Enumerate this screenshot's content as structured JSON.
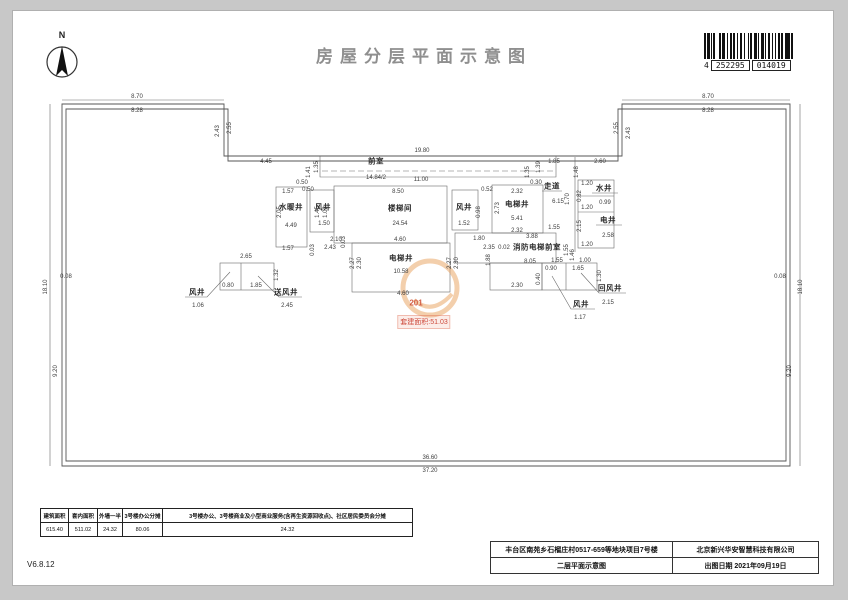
{
  "header": {
    "title": "房屋分层平面示意图",
    "north_label": "N",
    "barcode": {
      "g1": "4",
      "g2": "252295",
      "g3": "014019"
    }
  },
  "watermark": {
    "unit": "201",
    "text": "套建面积:51.03"
  },
  "plan": {
    "rooms": [
      {
        "t": "前室",
        "x": 376,
        "y": 161
      },
      {
        "t": "水暖井",
        "x": 291,
        "y": 207
      },
      {
        "t": "风井",
        "x": 323,
        "y": 207
      },
      {
        "t": "楼梯间",
        "x": 400,
        "y": 208
      },
      {
        "t": "电梯井",
        "x": 401,
        "y": 258
      },
      {
        "t": "电梯井",
        "x": 517,
        "y": 204
      },
      {
        "t": "风井",
        "x": 464,
        "y": 207
      },
      {
        "t": "走道",
        "x": 552,
        "y": 186
      },
      {
        "t": "水井",
        "x": 604,
        "y": 188
      },
      {
        "t": "电井",
        "x": 608,
        "y": 220
      },
      {
        "t": "消防电梯前室",
        "x": 537,
        "y": 247
      },
      {
        "t": "风井",
        "x": 197,
        "y": 292
      },
      {
        "t": "送风井",
        "x": 286,
        "y": 292
      },
      {
        "t": "风井",
        "x": 581,
        "y": 304
      },
      {
        "t": "回风井",
        "x": 610,
        "y": 288
      }
    ],
    "dims": [
      {
        "t": "8.70",
        "x": 137,
        "y": 97
      },
      {
        "t": "8.28",
        "x": 137,
        "y": 111
      },
      {
        "t": "8.70",
        "x": 708,
        "y": 97
      },
      {
        "t": "8.28",
        "x": 708,
        "y": 111
      },
      {
        "t": "2.43",
        "x": 218,
        "y": 131,
        "r": 1
      },
      {
        "t": "2.55",
        "x": 230,
        "y": 128,
        "r": 1
      },
      {
        "t": "2.55",
        "x": 617,
        "y": 128,
        "r": 1
      },
      {
        "t": "2.43",
        "x": 629,
        "y": 133,
        "r": 1
      },
      {
        "t": "4.45",
        "x": 266,
        "y": 162
      },
      {
        "t": "2.60",
        "x": 600,
        "y": 162
      },
      {
        "t": "19.80",
        "x": 422,
        "y": 151
      },
      {
        "t": "14.84/2",
        "x": 376,
        "y": 178
      },
      {
        "t": "11.00",
        "x": 421,
        "y": 180
      },
      {
        "t": "18.10",
        "x": 46,
        "y": 287,
        "r": 1
      },
      {
        "t": "0.08",
        "x": 66,
        "y": 277
      },
      {
        "t": "9.20",
        "x": 56,
        "y": 371,
        "r": 1
      },
      {
        "t": "18.10",
        "x": 801,
        "y": 287,
        "r": 1
      },
      {
        "t": "0.08",
        "x": 780,
        "y": 277
      },
      {
        "t": "9.20",
        "x": 790,
        "y": 371,
        "r": 1
      },
      {
        "t": "36.60",
        "x": 430,
        "y": 458
      },
      {
        "t": "37.20",
        "x": 430,
        "y": 471
      },
      {
        "t": "1.35",
        "x": 317,
        "y": 167,
        "r": 1
      },
      {
        "t": "1.41",
        "x": 309,
        "y": 172,
        "r": 1
      },
      {
        "t": "0.50",
        "x": 302,
        "y": 183
      },
      {
        "t": "1.39",
        "x": 539,
        "y": 167,
        "r": 1
      },
      {
        "t": "1.35",
        "x": 528,
        "y": 172,
        "r": 1
      },
      {
        "t": "0.30",
        "x": 536,
        "y": 183
      },
      {
        "t": "1.85",
        "x": 554,
        "y": 162
      },
      {
        "t": "1.48",
        "x": 577,
        "y": 172,
        "r": 1
      },
      {
        "t": "1.57",
        "x": 288,
        "y": 192
      },
      {
        "t": "2.05",
        "x": 280,
        "y": 212,
        "r": 1
      },
      {
        "t": "4.49",
        "x": 291,
        "y": 226
      },
      {
        "t": "1.57",
        "x": 288,
        "y": 249
      },
      {
        "t": "0.50",
        "x": 308,
        "y": 190
      },
      {
        "t": "0.03",
        "x": 313,
        "y": 250,
        "r": 1
      },
      {
        "t": "1.45",
        "x": 318,
        "y": 212,
        "r": 1
      },
      {
        "t": "1.02",
        "x": 326,
        "y": 212,
        "r": 1
      },
      {
        "t": "1.50",
        "x": 324,
        "y": 224
      },
      {
        "t": "8.50",
        "x": 398,
        "y": 192
      },
      {
        "t": "24.54",
        "x": 400,
        "y": 224
      },
      {
        "t": "4.60",
        "x": 400,
        "y": 240
      },
      {
        "t": "2.10",
        "x": 336,
        "y": 240
      },
      {
        "t": "2.43",
        "x": 330,
        "y": 248
      },
      {
        "t": "0.03",
        "x": 344,
        "y": 242,
        "r": 1
      },
      {
        "t": "2.27",
        "x": 353,
        "y": 263,
        "r": 1
      },
      {
        "t": "2.30",
        "x": 360,
        "y": 263,
        "r": 1
      },
      {
        "t": "10.58",
        "x": 401,
        "y": 272
      },
      {
        "t": "4.60",
        "x": 403,
        "y": 294
      },
      {
        "t": "2.27",
        "x": 450,
        "y": 263,
        "r": 1
      },
      {
        "t": "2.30",
        "x": 457,
        "y": 263,
        "r": 1
      },
      {
        "t": "1.52",
        "x": 464,
        "y": 224
      },
      {
        "t": "0.98",
        "x": 479,
        "y": 212,
        "r": 1
      },
      {
        "t": "2.73",
        "x": 498,
        "y": 208,
        "r": 1
      },
      {
        "t": "0.52",
        "x": 487,
        "y": 190
      },
      {
        "t": "2.32",
        "x": 517,
        "y": 192
      },
      {
        "t": "5.41",
        "x": 517,
        "y": 219
      },
      {
        "t": "2.32",
        "x": 517,
        "y": 231
      },
      {
        "t": "6.15",
        "x": 558,
        "y": 202
      },
      {
        "t": "1.70",
        "x": 568,
        "y": 199,
        "r": 1
      },
      {
        "t": "1.20",
        "x": 587,
        "y": 184
      },
      {
        "t": "0.82",
        "x": 580,
        "y": 196,
        "r": 1
      },
      {
        "t": "1.20",
        "x": 587,
        "y": 208
      },
      {
        "t": "0.99",
        "x": 605,
        "y": 203
      },
      {
        "t": "2.15",
        "x": 580,
        "y": 226,
        "r": 1
      },
      {
        "t": "2.58",
        "x": 608,
        "y": 236
      },
      {
        "t": "1.20",
        "x": 587,
        "y": 245
      },
      {
        "t": "1.80",
        "x": 479,
        "y": 239
      },
      {
        "t": "2.35",
        "x": 489,
        "y": 248
      },
      {
        "t": "0.02",
        "x": 504,
        "y": 248
      },
      {
        "t": "1.88",
        "x": 489,
        "y": 260,
        "r": 1
      },
      {
        "t": "1.55",
        "x": 554,
        "y": 228
      },
      {
        "t": "3.88",
        "x": 532,
        "y": 237
      },
      {
        "t": "8.05",
        "x": 530,
        "y": 262
      },
      {
        "t": "2.30",
        "x": 517,
        "y": 286
      },
      {
        "t": "0.40",
        "x": 539,
        "y": 279,
        "r": 1
      },
      {
        "t": "1.55",
        "x": 567,
        "y": 250,
        "r": 1
      },
      {
        "t": "1.46",
        "x": 573,
        "y": 255,
        "r": 1
      },
      {
        "t": "1.55",
        "x": 557,
        "y": 261
      },
      {
        "t": "1.00",
        "x": 585,
        "y": 261
      },
      {
        "t": "0.90",
        "x": 551,
        "y": 269
      },
      {
        "t": "1.65",
        "x": 578,
        "y": 269
      },
      {
        "t": "1.30",
        "x": 600,
        "y": 276,
        "r": 1
      },
      {
        "t": "1.17",
        "x": 580,
        "y": 318
      },
      {
        "t": "2.15",
        "x": 608,
        "y": 303
      },
      {
        "t": "2.65",
        "x": 246,
        "y": 257
      },
      {
        "t": "1.32",
        "x": 277,
        "y": 275,
        "r": 1
      },
      {
        "t": "0.80",
        "x": 228,
        "y": 286
      },
      {
        "t": "1.85",
        "x": 256,
        "y": 286
      },
      {
        "t": "1.06",
        "x": 198,
        "y": 306
      },
      {
        "t": "2.45",
        "x": 287,
        "y": 306
      }
    ]
  },
  "share_table": {
    "headers": [
      "建筑面积",
      "套内面积",
      "外墙一半",
      "3号楼办公分摊",
      "3号楼办公、3号楼商业及小型商业服务(含再生资源回收点)、社区居民委员会分摊"
    ],
    "values": [
      "615.40",
      "511.02",
      "24.32",
      "80.06",
      "24.32"
    ]
  },
  "title_block": {
    "project": "丰台区南苑乡石榴庄村0517-659等地块项目7号楼",
    "company": "北京新兴华安智慧科技有限公司",
    "drawing": "二层平面示意图",
    "date": "出图日期 2021年09月19日"
  },
  "footer": {
    "version": "V6.8.12"
  }
}
